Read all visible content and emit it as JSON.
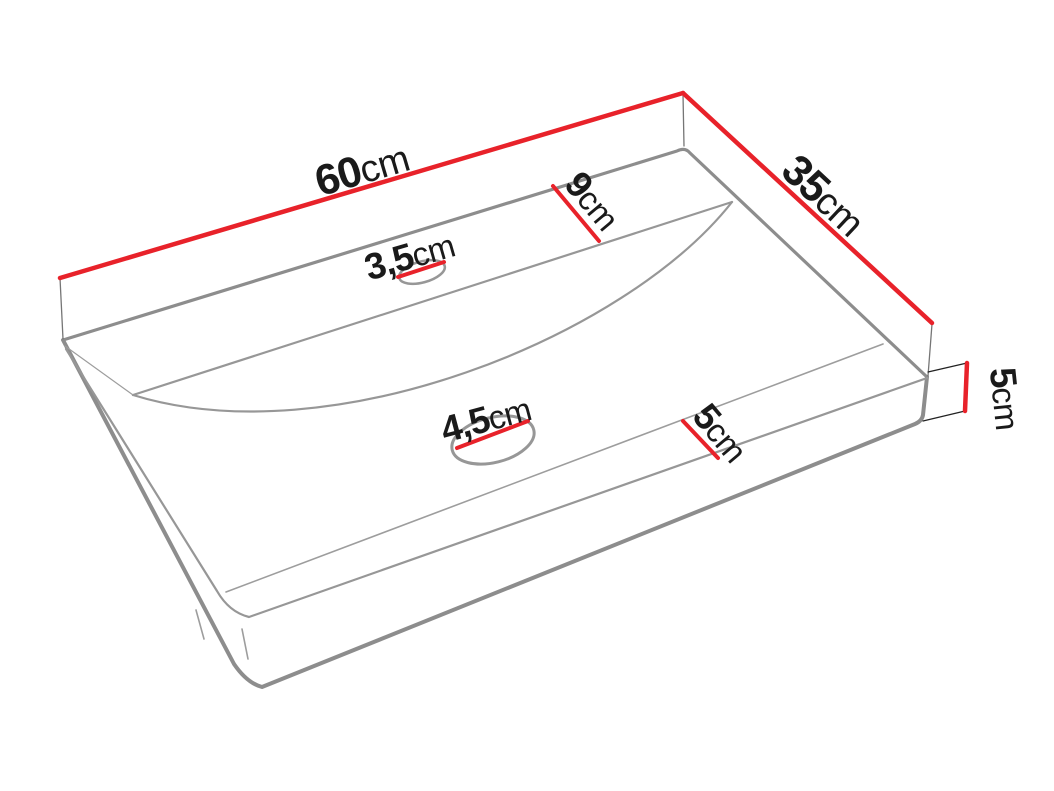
{
  "diagram": {
    "labels": {
      "width": {
        "value": "60",
        "unit": "cm"
      },
      "depth": {
        "value": "35",
        "unit": "cm"
      },
      "back_shelf": {
        "value": "9",
        "unit": "cm"
      },
      "tap_hole": {
        "value": "3,5",
        "unit": "cm"
      },
      "drain_hole": {
        "value": "4,5",
        "unit": "cm"
      },
      "front_ledge": {
        "value": "5",
        "unit": "cm"
      },
      "side_height": {
        "value": "5",
        "unit": "cm"
      }
    },
    "colors": {
      "dimension_red": "#e8222a",
      "outline_gray": "#8d8d8d",
      "inner_gray": "#979797",
      "thin_line": "#9d9d9d",
      "cap_gray": "#757575",
      "extension_black": "#222222",
      "label_text": "#1a1a1a",
      "background": "#ffffff"
    }
  }
}
